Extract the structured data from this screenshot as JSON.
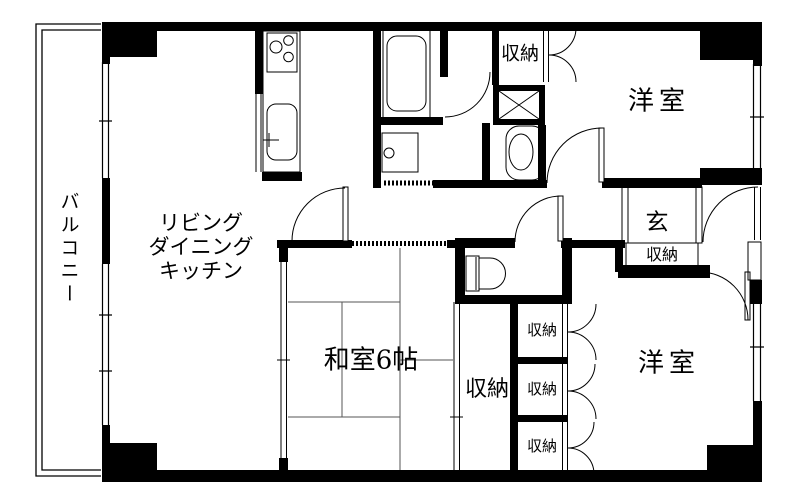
{
  "floorplan": {
    "labels": {
      "balcony": "バルコニー",
      "ldk": [
        "リビング",
        "ダイニング",
        "キッチン"
      ],
      "japanese_room": "和室6帖",
      "western_room_top": "洋室",
      "western_room_bottom": "洋室",
      "entrance": "玄",
      "closet_top": "収納",
      "closet_entrance": "収納",
      "closet_tall": "収納",
      "closet_small_1": "収納",
      "closet_small_2": "収納",
      "closet_small_3": "収納"
    },
    "colors": {
      "wall": "#000000",
      "background": "#ffffff",
      "thin_line": "#000000",
      "tatami_line": "#555555"
    }
  }
}
